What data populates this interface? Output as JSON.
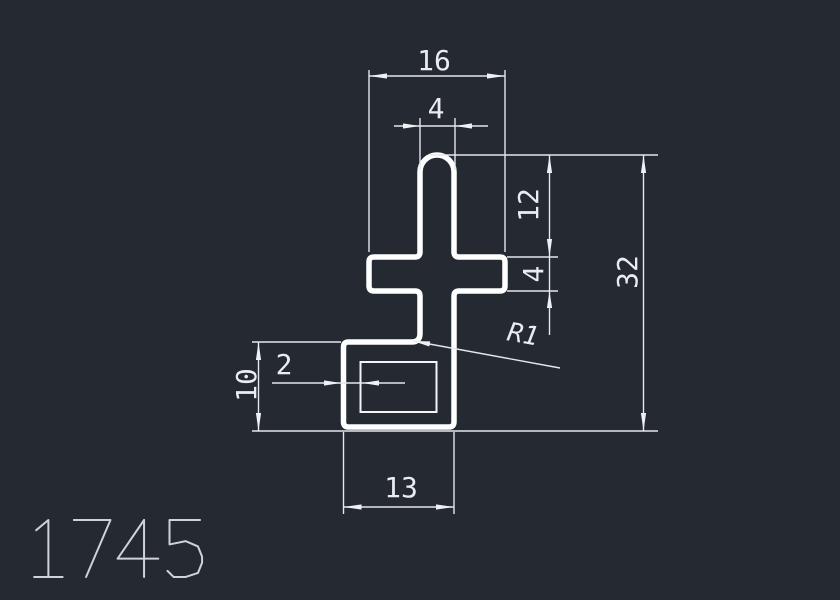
{
  "colors": {
    "background": "#242932",
    "profile_outline": "#ffffff",
    "dimension_lines": "#e4e8ec",
    "dimension_text": "#e9ecf0",
    "part_number_text": "#cfd3d7"
  },
  "drawing": {
    "part_number": "1745",
    "dims": {
      "arm_width": "16",
      "stem_width": "4",
      "upper_height": "12",
      "arm_thickness": "4",
      "overall_height": "32",
      "base_height": "10",
      "wall_thickness": "2",
      "base_width": "13",
      "fillet_radius": "R1"
    }
  }
}
